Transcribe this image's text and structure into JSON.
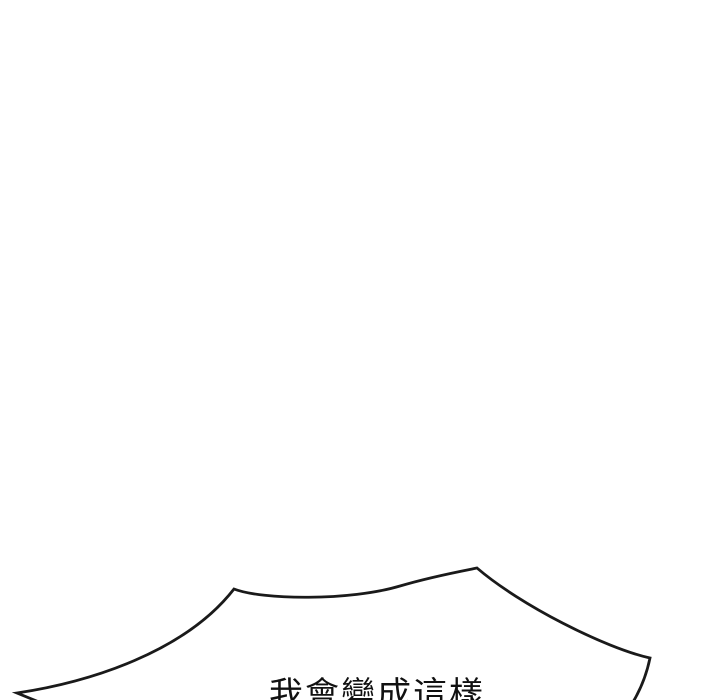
{
  "panel": {
    "background_color": "#ffffff",
    "outline_color": "#1a1a1a",
    "speech_bubble": {
      "text": "我會變成這樣",
      "text_color": "#111111",
      "visibility": "top edge of bubble and top of text clipped by bottom of frame"
    }
  }
}
